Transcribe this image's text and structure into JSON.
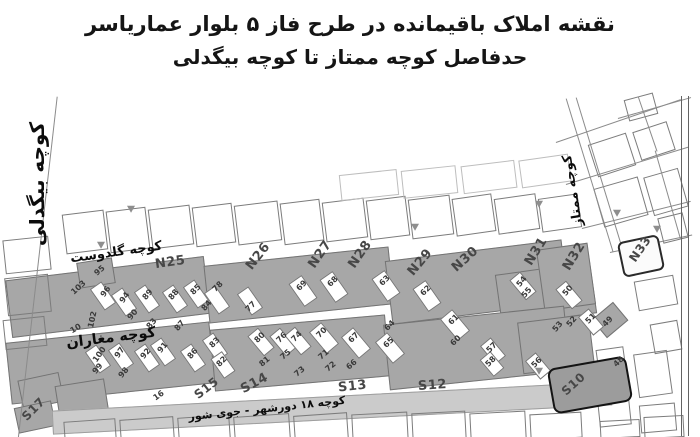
{
  "title": {
    "line1": "نقشه املاک باقیمانده در طرح فاز ۵ بلوار عماریاسر",
    "line2": "حدفاصل کوچه ممتاز تا کوچه بیگدلی"
  },
  "streets": {
    "bigdeli": {
      "label": "کوچه بیگدلی"
    },
    "goldust": {
      "label": "کوچه گلدوست"
    },
    "magharan": {
      "label": "کوچه مغاران"
    },
    "momtaz": {
      "label": "کوچه ممتاز"
    },
    "dowrshahr": {
      "label": "کوچه ۱۸ دورشهر - جوی شور"
    }
  },
  "blocks": [
    {
      "id": "N25",
      "x": 155,
      "y": 160,
      "r": -8,
      "s": 13
    },
    {
      "id": "N26",
      "x": 243,
      "y": 154,
      "r": -52,
      "s": 13
    },
    {
      "id": "N27",
      "x": 305,
      "y": 152,
      "r": -55,
      "s": 13
    },
    {
      "id": "N28",
      "x": 345,
      "y": 152,
      "r": -55,
      "s": 13
    },
    {
      "id": "N29",
      "x": 405,
      "y": 160,
      "r": -50,
      "s": 13
    },
    {
      "id": "N30",
      "x": 450,
      "y": 157,
      "r": -42,
      "s": 13
    },
    {
      "id": "N31",
      "x": 521,
      "y": 149,
      "r": -58,
      "s": 13
    },
    {
      "id": "N32",
      "x": 559,
      "y": 154,
      "r": -58,
      "s": 13
    },
    {
      "id": "N33",
      "x": 626,
      "y": 147,
      "r": -55,
      "s": 12
    },
    {
      "id": "S10",
      "x": 560,
      "y": 282,
      "r": -42,
      "s": 12
    },
    {
      "id": "S12",
      "x": 418,
      "y": 283,
      "r": -4,
      "s": 13
    },
    {
      "id": "S13",
      "x": 338,
      "y": 284,
      "r": -6,
      "s": 13
    },
    {
      "id": "S14",
      "x": 240,
      "y": 281,
      "r": -28,
      "s": 13
    },
    {
      "id": "S15",
      "x": 193,
      "y": 286,
      "r": -38,
      "s": 12
    },
    {
      "id": "S17",
      "x": 20,
      "y": 307,
      "r": -45,
      "s": 12
    }
  ],
  "parcels": [
    {
      "n": "95",
      "x": 94,
      "y": 171,
      "r": -40
    },
    {
      "n": "103",
      "x": 70,
      "y": 188,
      "r": -42
    },
    {
      "n": "96",
      "x": 100,
      "y": 192,
      "r": -55
    },
    {
      "n": "94",
      "x": 119,
      "y": 198,
      "r": -55
    },
    {
      "n": "89",
      "x": 142,
      "y": 195,
      "r": -50
    },
    {
      "n": "88",
      "x": 168,
      "y": 195,
      "r": -50
    },
    {
      "n": "85",
      "x": 190,
      "y": 190,
      "r": -45
    },
    {
      "n": "84",
      "x": 201,
      "y": 206,
      "r": -50
    },
    {
      "n": "78",
      "x": 212,
      "y": 187,
      "r": -45
    },
    {
      "n": "77",
      "x": 245,
      "y": 207,
      "r": -45
    },
    {
      "n": "90",
      "x": 127,
      "y": 215,
      "r": -50
    },
    {
      "n": "83",
      "x": 146,
      "y": 224,
      "r": -50
    },
    {
      "n": "87",
      "x": 174,
      "y": 226,
      "r": -50
    },
    {
      "n": "102",
      "x": 84,
      "y": 220,
      "r": -78
    },
    {
      "n": "10",
      "x": 70,
      "y": 229,
      "r": -30
    },
    {
      "n": "69",
      "x": 296,
      "y": 186,
      "r": -45
    },
    {
      "n": "68",
      "x": 327,
      "y": 182,
      "r": -45
    },
    {
      "n": "63",
      "x": 379,
      "y": 181,
      "r": -45
    },
    {
      "n": "62",
      "x": 420,
      "y": 191,
      "r": -45
    },
    {
      "n": "61",
      "x": 448,
      "y": 220,
      "r": -45
    },
    {
      "n": "60",
      "x": 450,
      "y": 241,
      "r": -45
    },
    {
      "n": "64",
      "x": 384,
      "y": 226,
      "r": -45
    },
    {
      "n": "65",
      "x": 383,
      "y": 243,
      "r": -45
    },
    {
      "n": "54",
      "x": 516,
      "y": 182,
      "r": -50
    },
    {
      "n": "55",
      "x": 521,
      "y": 193,
      "r": -50
    },
    {
      "n": "50",
      "x": 562,
      "y": 191,
      "r": -50
    },
    {
      "n": "53",
      "x": 552,
      "y": 227,
      "r": -50
    },
    {
      "n": "52",
      "x": 566,
      "y": 222,
      "r": -50
    },
    {
      "n": "51",
      "x": 585,
      "y": 219,
      "r": -45
    },
    {
      "n": "49",
      "x": 602,
      "y": 222,
      "r": -45
    },
    {
      "n": "100",
      "x": 91,
      "y": 255,
      "r": -55
    },
    {
      "n": "99",
      "x": 92,
      "y": 269,
      "r": -50
    },
    {
      "n": "97",
      "x": 114,
      "y": 253,
      "r": -55
    },
    {
      "n": "98",
      "x": 118,
      "y": 273,
      "r": -50
    },
    {
      "n": "92",
      "x": 140,
      "y": 254,
      "r": -50
    },
    {
      "n": "91",
      "x": 157,
      "y": 248,
      "r": -50
    },
    {
      "n": "86",
      "x": 187,
      "y": 254,
      "r": -50
    },
    {
      "n": "83",
      "x": 209,
      "y": 243,
      "r": -45
    },
    {
      "n": "82",
      "x": 216,
      "y": 262,
      "r": -45
    },
    {
      "n": "16",
      "x": 153,
      "y": 296,
      "r": -35
    },
    {
      "n": "80",
      "x": 254,
      "y": 238,
      "r": -45
    },
    {
      "n": "81",
      "x": 259,
      "y": 262,
      "r": -40
    },
    {
      "n": "76",
      "x": 276,
      "y": 238,
      "r": -45
    },
    {
      "n": "75",
      "x": 280,
      "y": 255,
      "r": -40
    },
    {
      "n": "74",
      "x": 291,
      "y": 237,
      "r": -45
    },
    {
      "n": "73",
      "x": 294,
      "y": 272,
      "r": -40
    },
    {
      "n": "70",
      "x": 316,
      "y": 233,
      "r": -45
    },
    {
      "n": "71",
      "x": 318,
      "y": 255,
      "r": -40
    },
    {
      "n": "72",
      "x": 325,
      "y": 267,
      "r": -40
    },
    {
      "n": "67",
      "x": 348,
      "y": 238,
      "r": -45
    },
    {
      "n": "66",
      "x": 346,
      "y": 265,
      "r": -40
    },
    {
      "n": "57",
      "x": 486,
      "y": 248,
      "r": -45
    },
    {
      "n": "58",
      "x": 485,
      "y": 262,
      "r": -45
    },
    {
      "n": "56",
      "x": 531,
      "y": 263,
      "r": -45
    },
    {
      "n": "48",
      "x": 613,
      "y": 262,
      "r": -45
    }
  ],
  "map": {
    "shapes": [
      [
        8,
        173,
        200,
        58,
        -7,
        "g"
      ],
      [
        206,
        161,
        186,
        58,
        -6,
        "g"
      ],
      [
        388,
        155,
        178,
        64,
        -7,
        "g"
      ],
      [
        498,
        173,
        96,
        52,
        -8,
        "g"
      ],
      [
        540,
        151,
        52,
        62,
        -8,
        "g"
      ],
      [
        8,
        237,
        205,
        62,
        -6,
        "g"
      ],
      [
        212,
        227,
        176,
        62,
        -5,
        "g"
      ],
      [
        386,
        220,
        182,
        66,
        -6,
        "g"
      ],
      [
        520,
        223,
        72,
        52,
        -7,
        "g"
      ],
      [
        78,
        165,
        36,
        26,
        -9,
        "g"
      ],
      [
        20,
        281,
        42,
        30,
        -12,
        "g"
      ],
      [
        16,
        309,
        38,
        26,
        -12,
        "g"
      ],
      [
        58,
        287,
        50,
        48,
        -9,
        "g"
      ],
      [
        596,
        213,
        28,
        24,
        -40,
        "g"
      ],
      [
        52,
        301,
        560,
        24,
        -3,
        "l"
      ],
      [
        96,
        188,
        14,
        26,
        -35,
        "w"
      ],
      [
        117,
        194,
        14,
        26,
        -35,
        "w"
      ],
      [
        140,
        191,
        14,
        26,
        -35,
        "w"
      ],
      [
        168,
        191,
        14,
        26,
        -35,
        "w"
      ],
      [
        189,
        186,
        14,
        26,
        -35,
        "w"
      ],
      [
        210,
        192,
        14,
        26,
        -35,
        "w"
      ],
      [
        243,
        193,
        14,
        26,
        -35,
        "w"
      ],
      [
        295,
        182,
        16,
        28,
        -35,
        "w"
      ],
      [
        326,
        178,
        16,
        28,
        -35,
        "w"
      ],
      [
        378,
        177,
        16,
        28,
        -35,
        "w"
      ],
      [
        419,
        187,
        16,
        28,
        -35,
        "w"
      ],
      [
        447,
        216,
        16,
        28,
        -40,
        "w"
      ],
      [
        516,
        178,
        14,
        26,
        -40,
        "w"
      ],
      [
        562,
        187,
        14,
        26,
        -40,
        "w"
      ],
      [
        584,
        215,
        14,
        24,
        -40,
        "w"
      ],
      [
        91,
        251,
        14,
        26,
        -35,
        "w"
      ],
      [
        114,
        249,
        14,
        26,
        -35,
        "w"
      ],
      [
        140,
        250,
        14,
        26,
        -35,
        "w"
      ],
      [
        156,
        244,
        14,
        26,
        -35,
        "w"
      ],
      [
        186,
        250,
        14,
        26,
        -35,
        "w"
      ],
      [
        208,
        239,
        14,
        26,
        -35,
        "w"
      ],
      [
        216,
        258,
        14,
        24,
        -35,
        "w"
      ],
      [
        254,
        234,
        14,
        26,
        -40,
        "w"
      ],
      [
        276,
        234,
        14,
        26,
        -40,
        "w"
      ],
      [
        291,
        233,
        14,
        26,
        -40,
        "w"
      ],
      [
        316,
        229,
        16,
        28,
        -40,
        "w"
      ],
      [
        348,
        234,
        16,
        28,
        -40,
        "w"
      ],
      [
        382,
        239,
        16,
        28,
        -40,
        "w"
      ],
      [
        486,
        244,
        14,
        24,
        -40,
        "w"
      ],
      [
        485,
        258,
        14,
        22,
        -40,
        "w"
      ],
      [
        531,
        259,
        14,
        24,
        -40,
        "w"
      ],
      [
        64,
        117,
        42,
        40,
        -7,
        "o"
      ],
      [
        108,
        114,
        40,
        42,
        -7,
        "o"
      ],
      [
        150,
        112,
        42,
        40,
        -7,
        "o"
      ],
      [
        194,
        110,
        40,
        40,
        -7,
        "o"
      ],
      [
        236,
        108,
        44,
        40,
        -7,
        "o"
      ],
      [
        282,
        106,
        40,
        42,
        -7,
        "o"
      ],
      [
        324,
        105,
        42,
        40,
        -7,
        "o"
      ],
      [
        368,
        103,
        40,
        40,
        -7,
        "o"
      ],
      [
        410,
        102,
        42,
        40,
        -7,
        "o"
      ],
      [
        454,
        101,
        40,
        38,
        -8,
        "o"
      ],
      [
        496,
        101,
        42,
        36,
        -8,
        "o"
      ],
      [
        540,
        101,
        40,
        34,
        -8,
        "o"
      ],
      [
        340,
        77,
        58,
        26,
        -6,
        "f"
      ],
      [
        402,
        73,
        55,
        28,
        -6,
        "f"
      ],
      [
        462,
        68,
        54,
        28,
        -7,
        "f"
      ],
      [
        520,
        62,
        50,
        28,
        -8,
        "f"
      ],
      [
        4,
        143,
        46,
        34,
        -6,
        "o"
      ],
      [
        6,
        181,
        44,
        38,
        -6,
        "o"
      ],
      [
        4,
        223,
        42,
        30,
        -6,
        "o"
      ],
      [
        64,
        325,
        52,
        20,
        -4,
        "o"
      ],
      [
        120,
        323,
        54,
        22,
        -4,
        "o"
      ],
      [
        178,
        321,
        52,
        24,
        -4,
        "o"
      ],
      [
        234,
        320,
        56,
        26,
        -4,
        "o"
      ],
      [
        294,
        319,
        54,
        28,
        -4,
        "o"
      ],
      [
        352,
        318,
        56,
        30,
        -3,
        "o"
      ],
      [
        412,
        317,
        54,
        30,
        -3,
        "o"
      ],
      [
        470,
        317,
        56,
        28,
        -3,
        "o"
      ],
      [
        530,
        318,
        52,
        26,
        -3,
        "o"
      ],
      [
        600,
        325,
        40,
        18,
        -3,
        "o"
      ],
      [
        644,
        321,
        40,
        22,
        -3,
        "o"
      ],
      [
        636,
        183,
        40,
        30,
        -10,
        "o"
      ],
      [
        598,
        253,
        28,
        38,
        -8,
        "o"
      ],
      [
        636,
        257,
        34,
        44,
        -8,
        "o"
      ],
      [
        598,
        295,
        32,
        36,
        -6,
        "o"
      ],
      [
        652,
        227,
        28,
        30,
        -10,
        "o"
      ],
      [
        640,
        309,
        36,
        28,
        -5,
        "o"
      ],
      [
        592,
        43,
        40,
        34,
        -18,
        "o"
      ],
      [
        636,
        31,
        36,
        30,
        -18,
        "o"
      ],
      [
        598,
        87,
        46,
        40,
        -16,
        "o"
      ],
      [
        648,
        77,
        36,
        40,
        -16,
        "o"
      ],
      [
        626,
        1,
        30,
        22,
        -15,
        "o"
      ],
      [
        660,
        120,
        26,
        26,
        -14,
        "o"
      ],
      [
        620,
        143,
        42,
        36,
        -12,
        "k"
      ],
      [
        550,
        267,
        80,
        46,
        -10,
        "s"
      ]
    ],
    "lines": [
      [
        57,
        1,
        346,
        96.5
      ],
      [
        566,
        3,
        160,
        73
      ],
      [
        576,
        2,
        162,
        73
      ],
      [
        556,
        47,
        132,
        -19
      ],
      [
        566,
        89,
        128,
        -17
      ],
      [
        582,
        133,
        112,
        -14
      ],
      [
        618,
        23,
        76,
        -16
      ],
      [
        610,
        157,
        84,
        -12
      ],
      [
        655,
        55,
        92,
        74
      ],
      [
        638,
        1,
        58,
        71
      ]
    ],
    "icons": [
      [
        126,
        109
      ],
      [
        410,
        127
      ],
      [
        534,
        104
      ],
      [
        612,
        113
      ],
      [
        652,
        129
      ],
      [
        534,
        271
      ],
      [
        96,
        145
      ]
    ]
  }
}
